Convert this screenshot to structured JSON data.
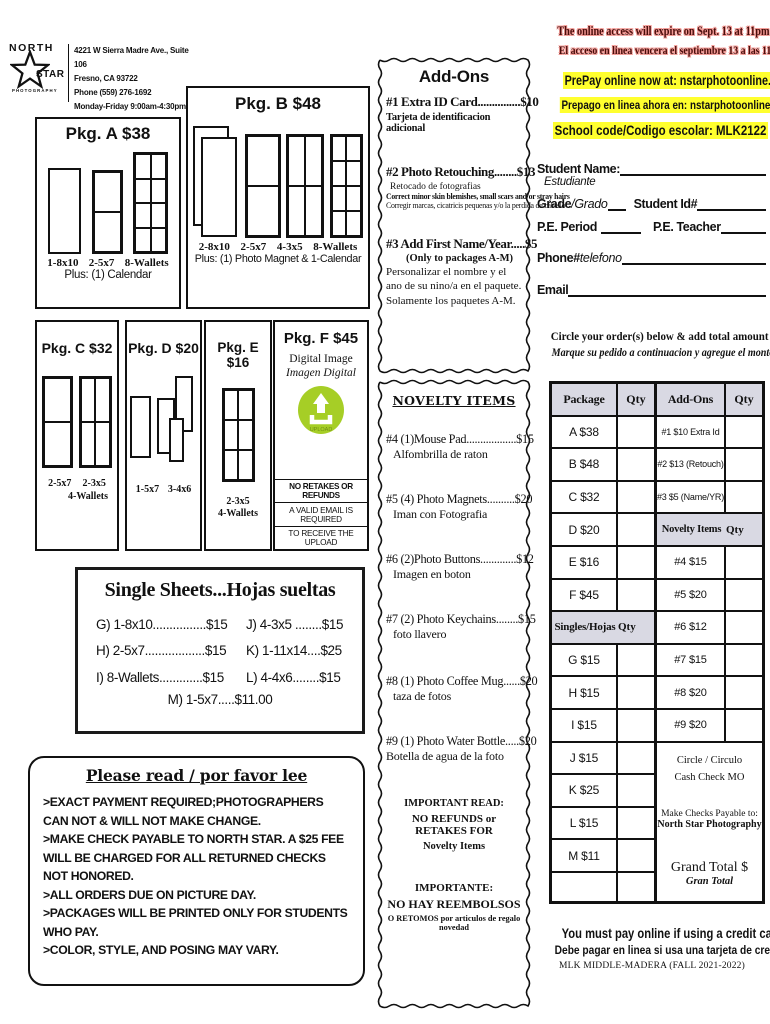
{
  "colors": {
    "highlight_yellow": "#ffff2e",
    "warning_text": "#4a0e0c",
    "warning_glow": "#f49b96",
    "upload_green": "#a6ce26",
    "table_header_bg": "#d9d9e3"
  },
  "header": {
    "logo": {
      "line1": "NORTH",
      "line2": "STAR",
      "line3": "PHOTOGRAPHY"
    },
    "address": [
      "4221 W Sierra Madre Ave., Suite 106",
      "Fresno, CA 93722",
      "Phone (559) 276-1692",
      "Monday-Friday  9:00am-4:30pm"
    ]
  },
  "packages": {
    "a": {
      "title": "Pkg. A $38",
      "labels": [
        "1-8x10",
        "2-5x7",
        "8-Wallets"
      ],
      "plus": "Plus: (1) Calendar"
    },
    "b": {
      "title": "Pkg. B $48",
      "labels": [
        "2-8x10",
        "2-5x7",
        "4-3x5",
        "8-Wallets"
      ],
      "plus": "Plus: (1) Photo Magnet & 1-Calendar"
    },
    "c": {
      "title": "Pkg. C $32",
      "labels": [
        "2-5x7",
        "2-3x5"
      ],
      "label2": "4-Wallets"
    },
    "d": {
      "title": "Pkg. D $20",
      "labels": [
        "1-5x7",
        "3-4x6"
      ]
    },
    "e": {
      "title": "Pkg. E $16",
      "labels": [
        "2-3x5"
      ],
      "label2": "4-Wallets"
    },
    "f": {
      "title": "Pkg. F $45",
      "line1": "Digital Image",
      "line2": "Imagen Digital",
      "upload_label": "UPLOAD",
      "notes": [
        "NO RETAKES OR REFUNDS",
        "A VALID EMAIL IS REQUIRED",
        "TO RECEIVE THE UPLOAD"
      ]
    }
  },
  "single_sheets": {
    "title": "Single Sheets...Hojas sueltas",
    "col1": [
      "G) 1-8x10................$15",
      "H) 2-5x7..................$15",
      "I) 8-Wallets.............$15"
    ],
    "col2": [
      "J) 4-3x5 ........$15",
      "K) 1-11x14....$25",
      "L) 4-4x6........$15"
    ],
    "last": "M) 1-5x7.....$11.00"
  },
  "please_read": {
    "title": "Please read / por favor lee",
    "lines": [
      ">EXACT PAYMENT REQUIRED;PHOTOGRAPHERS CAN NOT & WILL NOT MAKE CHANGE.",
      ">MAKE CHECK PAYABLE TO NORTH STAR. A $25 FEE WILL BE CHARGED FOR ALL RETURNED CHECKS NOT HONORED.",
      ">ALL ORDERS DUE ON PICTURE DAY.",
      ">PACKAGES WILL BE PRINTED ONLY FOR STUDENTS WHO PAY.",
      ">COLOR, STYLE, AND POSING MAY VARY."
    ]
  },
  "addons": {
    "title": "Add-Ons",
    "item1": {
      "name": "#1 Extra ID Card...............$10",
      "sub": "Tarjeta de identificacion adicional"
    },
    "item2": {
      "name": "#2 Photo Retouching........$13",
      "sub1": "Retocado de fotografias",
      "sub2": "Correct minor skin blemishes, small scars and/or stray hairs",
      "sub3": "Corregir marcas, cicatricis pequenas y/o la perdida de cabello"
    },
    "item3": {
      "name": "#3 Add First Name/Year.....$5",
      "sub1": "(Only to packages A-M)",
      "sub2": "Personalizar el nombre y el ano de su nino/a en el paquete. Solamente los paquetes A-M."
    }
  },
  "novelty": {
    "title": "NOVELTY ITEMS",
    "items": [
      {
        "name": "#4 (1)Mouse Pad..................$15",
        "sub": "Alfombrilla de raton"
      },
      {
        "name": "#5 (4) Photo Magnets..........$20",
        "sub": "Iman con Fotografia"
      },
      {
        "name": "#6 (2)Photo Buttons.............$12",
        "sub": "Imagen en boton"
      },
      {
        "name": "#7 (2) Photo Keychains........$15",
        "sub": "foto llavero"
      },
      {
        "name": "#8 (1) Photo Coffee Mug......$20",
        "sub": "taza de fotos"
      },
      {
        "name": "#9 (1) Photo Water Bottle.....$20",
        "sub": "Botella de agua de la foto"
      }
    ],
    "important_en": [
      "IMPORTANT READ:",
      "NO REFUNDS or RETAKES FOR",
      "Novelty Items"
    ],
    "important_es": [
      "IMPORTANTE:",
      "NO HAY REEMBOLSOS",
      "O RETOMOS por articulos de regalo novedad"
    ]
  },
  "right": {
    "expire_en": "The online access will expire on Sept. 13 at 11pm",
    "expire_es": "El acceso en linea vencera el septiembre 13 a las 11pm",
    "prepay_en": "PrePay online now at: nstarphotoonline.com",
    "prepay_es": "Prepago en linea ahora en: nstarphotoonline.com",
    "school_code": "School code/Codigo escolar: MLK2122",
    "fields": {
      "student_name": "Student Name:",
      "student_name_es": "Estudiante",
      "grade": "Grade",
      "grade_es": "/Grado",
      "student_id": "Student Id#",
      "pe_period": "P.E. Period",
      "pe_teacher": "P.E. Teacher",
      "phone": "Phone#",
      "phone_es": "telefono",
      "email": "Email"
    },
    "order": {
      "instr_en": "Circle your order(s) below & add total amount",
      "instr_es": "Marque su pedido a continuacion y agregue el monto total",
      "pkg_header": [
        "Package",
        "Qty"
      ],
      "pkg_rows": [
        "A  $38",
        "B  $48",
        "C  $32",
        "D  $20",
        "E  $16",
        "F  $45"
      ],
      "singles_header": [
        "Singles/Hojas",
        "Qty"
      ],
      "single_rows": [
        "G  $15",
        "H  $15",
        "I  $15",
        "J  $15",
        "K  $25",
        "L  $15",
        "M  $11"
      ],
      "addons_header": [
        "Add-Ons",
        "Qty"
      ],
      "addon_rows": [
        "#1  $10 Extra Id",
        "#2  $13 (Retouch)",
        "#3 $5 (Name/YR)"
      ],
      "novelty_header": [
        "Novelty Items",
        "Qty"
      ],
      "novelty_rows": [
        "#4  $15",
        "#5  $20",
        "#6  $12",
        "#7  $15",
        "#8  $20",
        "#9  $20"
      ],
      "payment": {
        "circle": "Circle / Circulo",
        "methods": "Cash  Check  MO",
        "payable1": "Make Checks Payable to:",
        "payable2": "North Star Photography",
        "total": "Grand Total $",
        "total_es": "Gran Total"
      }
    },
    "footer": {
      "line1": "You must pay online if using a credit card",
      "line2": "Debe pagar en linea si usa una tarjeta de credito",
      "line3": "MLK MIDDLE-MADERA (FALL 2021-2022)"
    }
  }
}
